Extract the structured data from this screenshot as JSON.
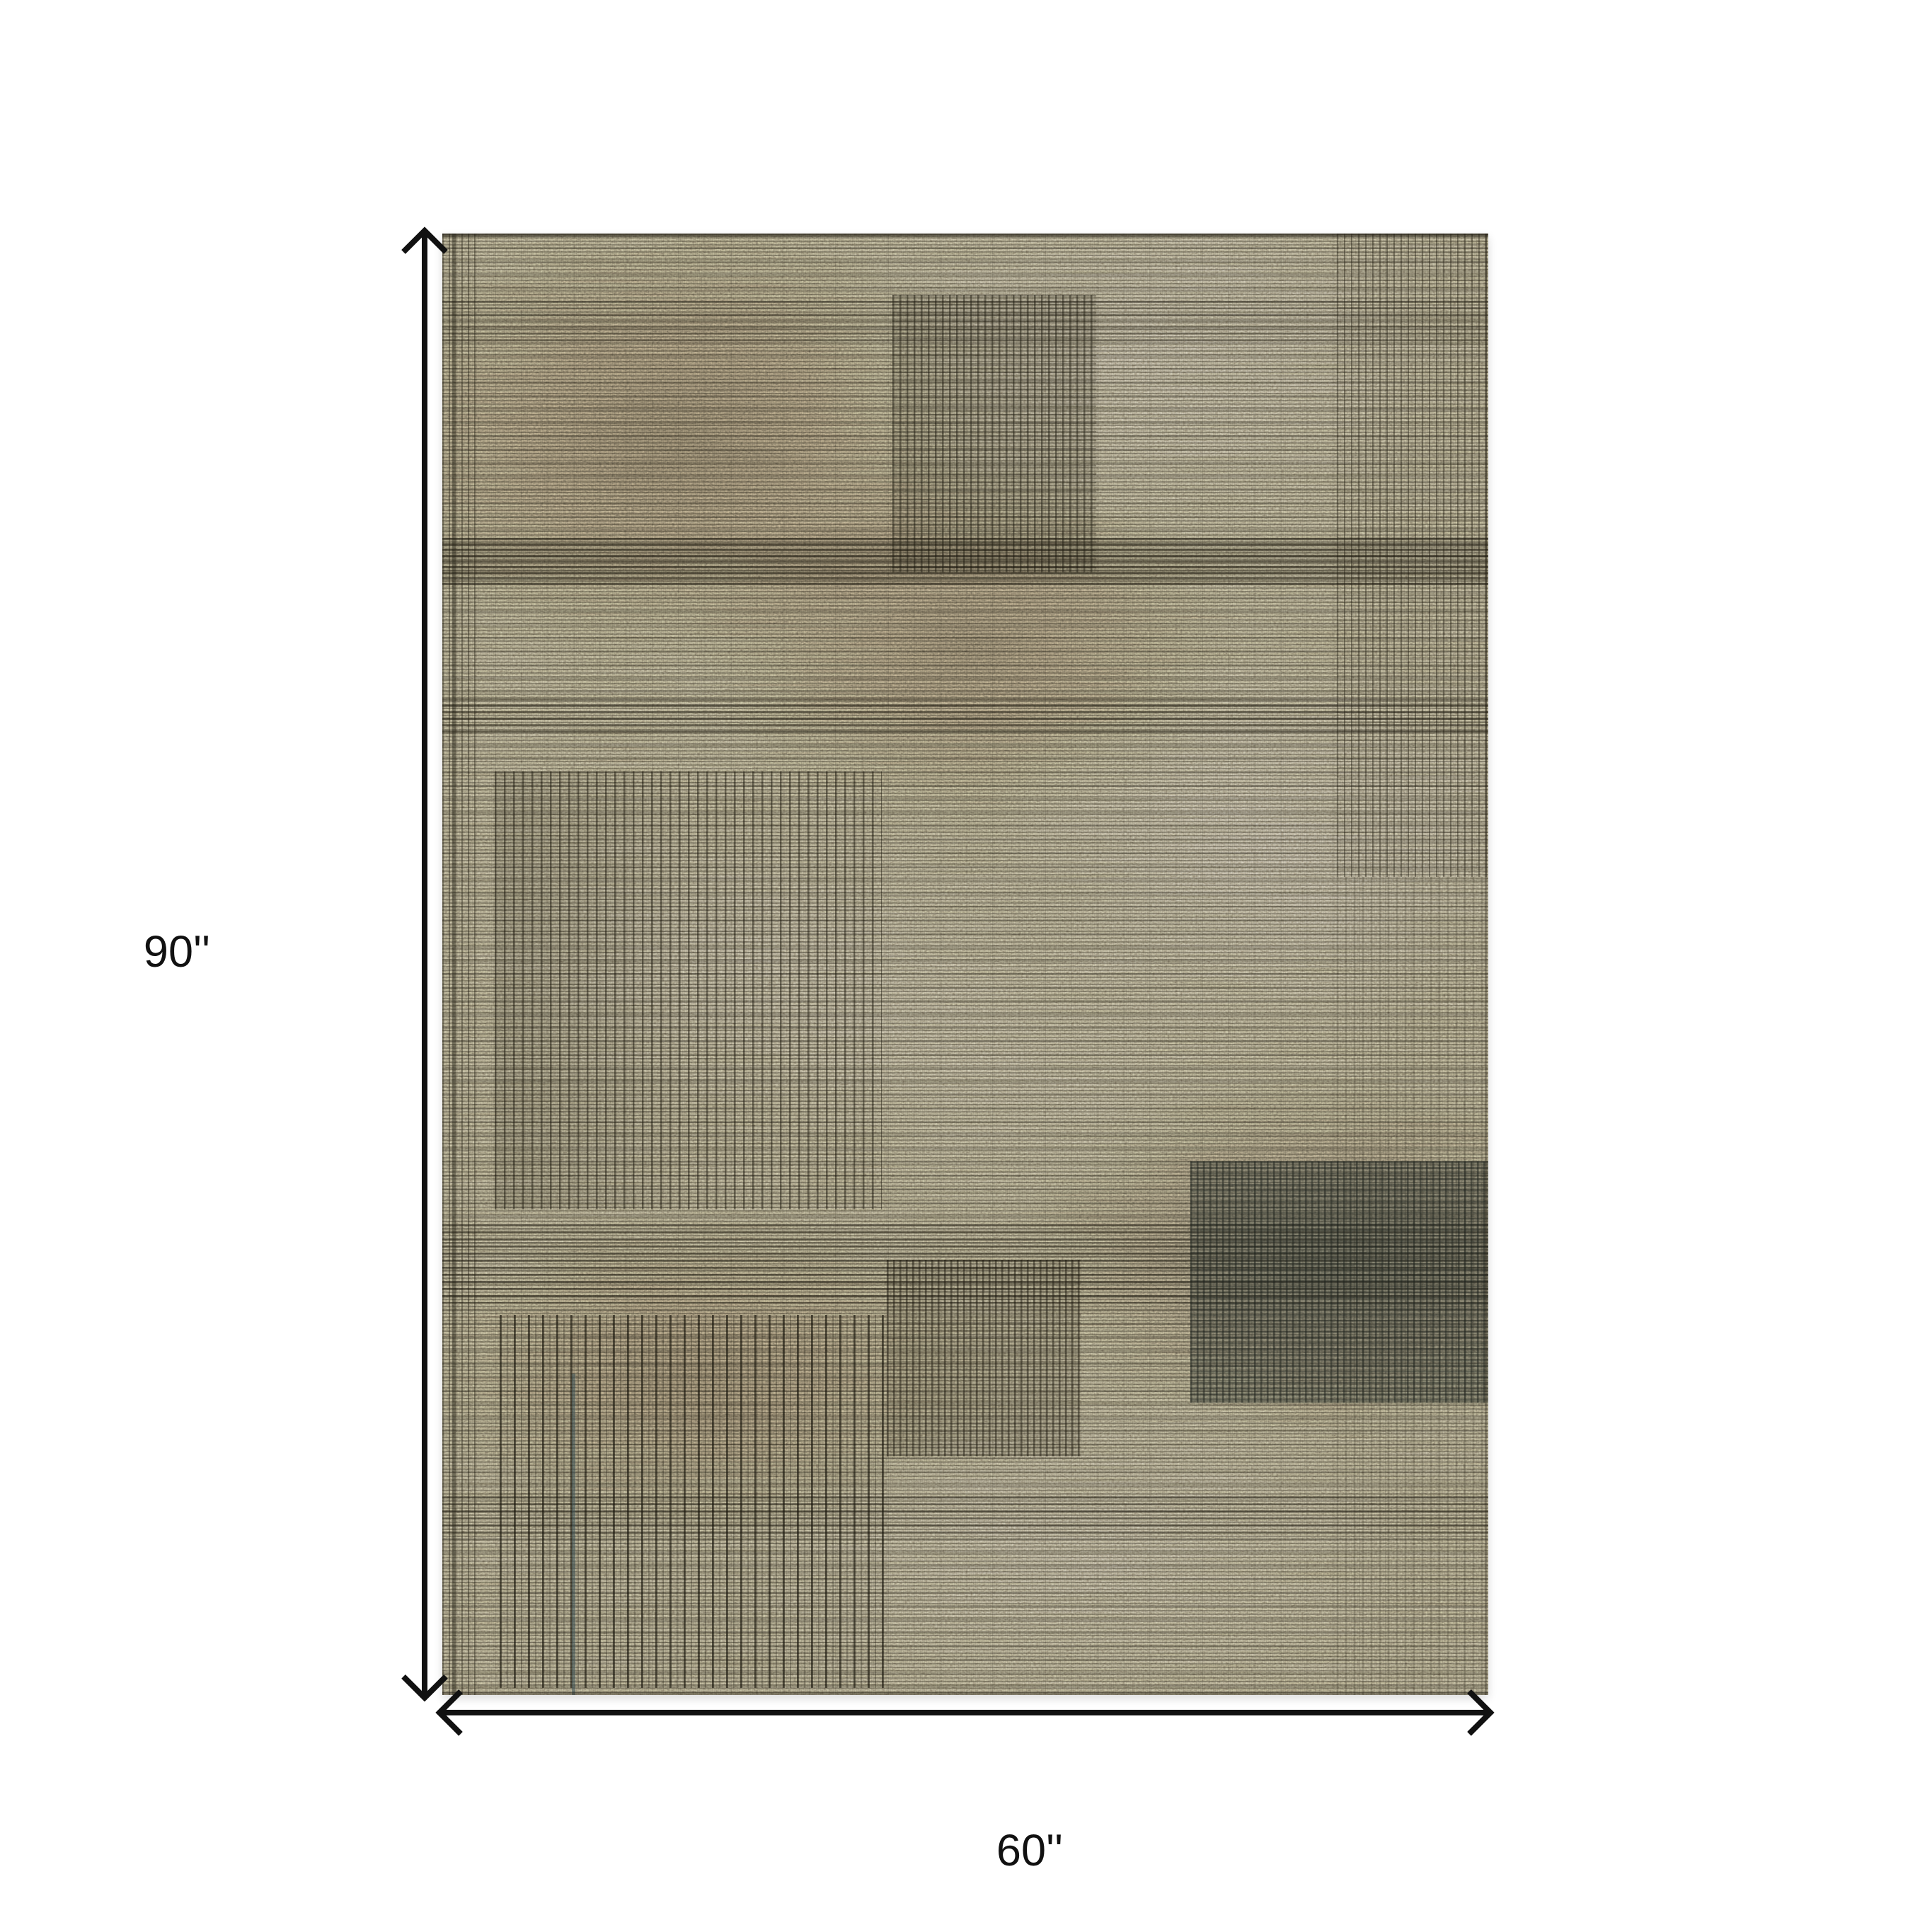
{
  "diagram": {
    "type": "product-dimension-diagram",
    "subject": "distressed taupe pinstripe area rug, top view",
    "height_label": "90''",
    "width_label": "60''"
  },
  "theme": {
    "background": "#ffffff",
    "arrow_color": "#111111",
    "label_color": "#111111",
    "rug_base": "#9b9078",
    "rug_dark": "#4f4a38",
    "rug_light": "#b3a88d",
    "rug_stripe": "#2c2818",
    "rug_teal_patch": "#3e5458"
  }
}
